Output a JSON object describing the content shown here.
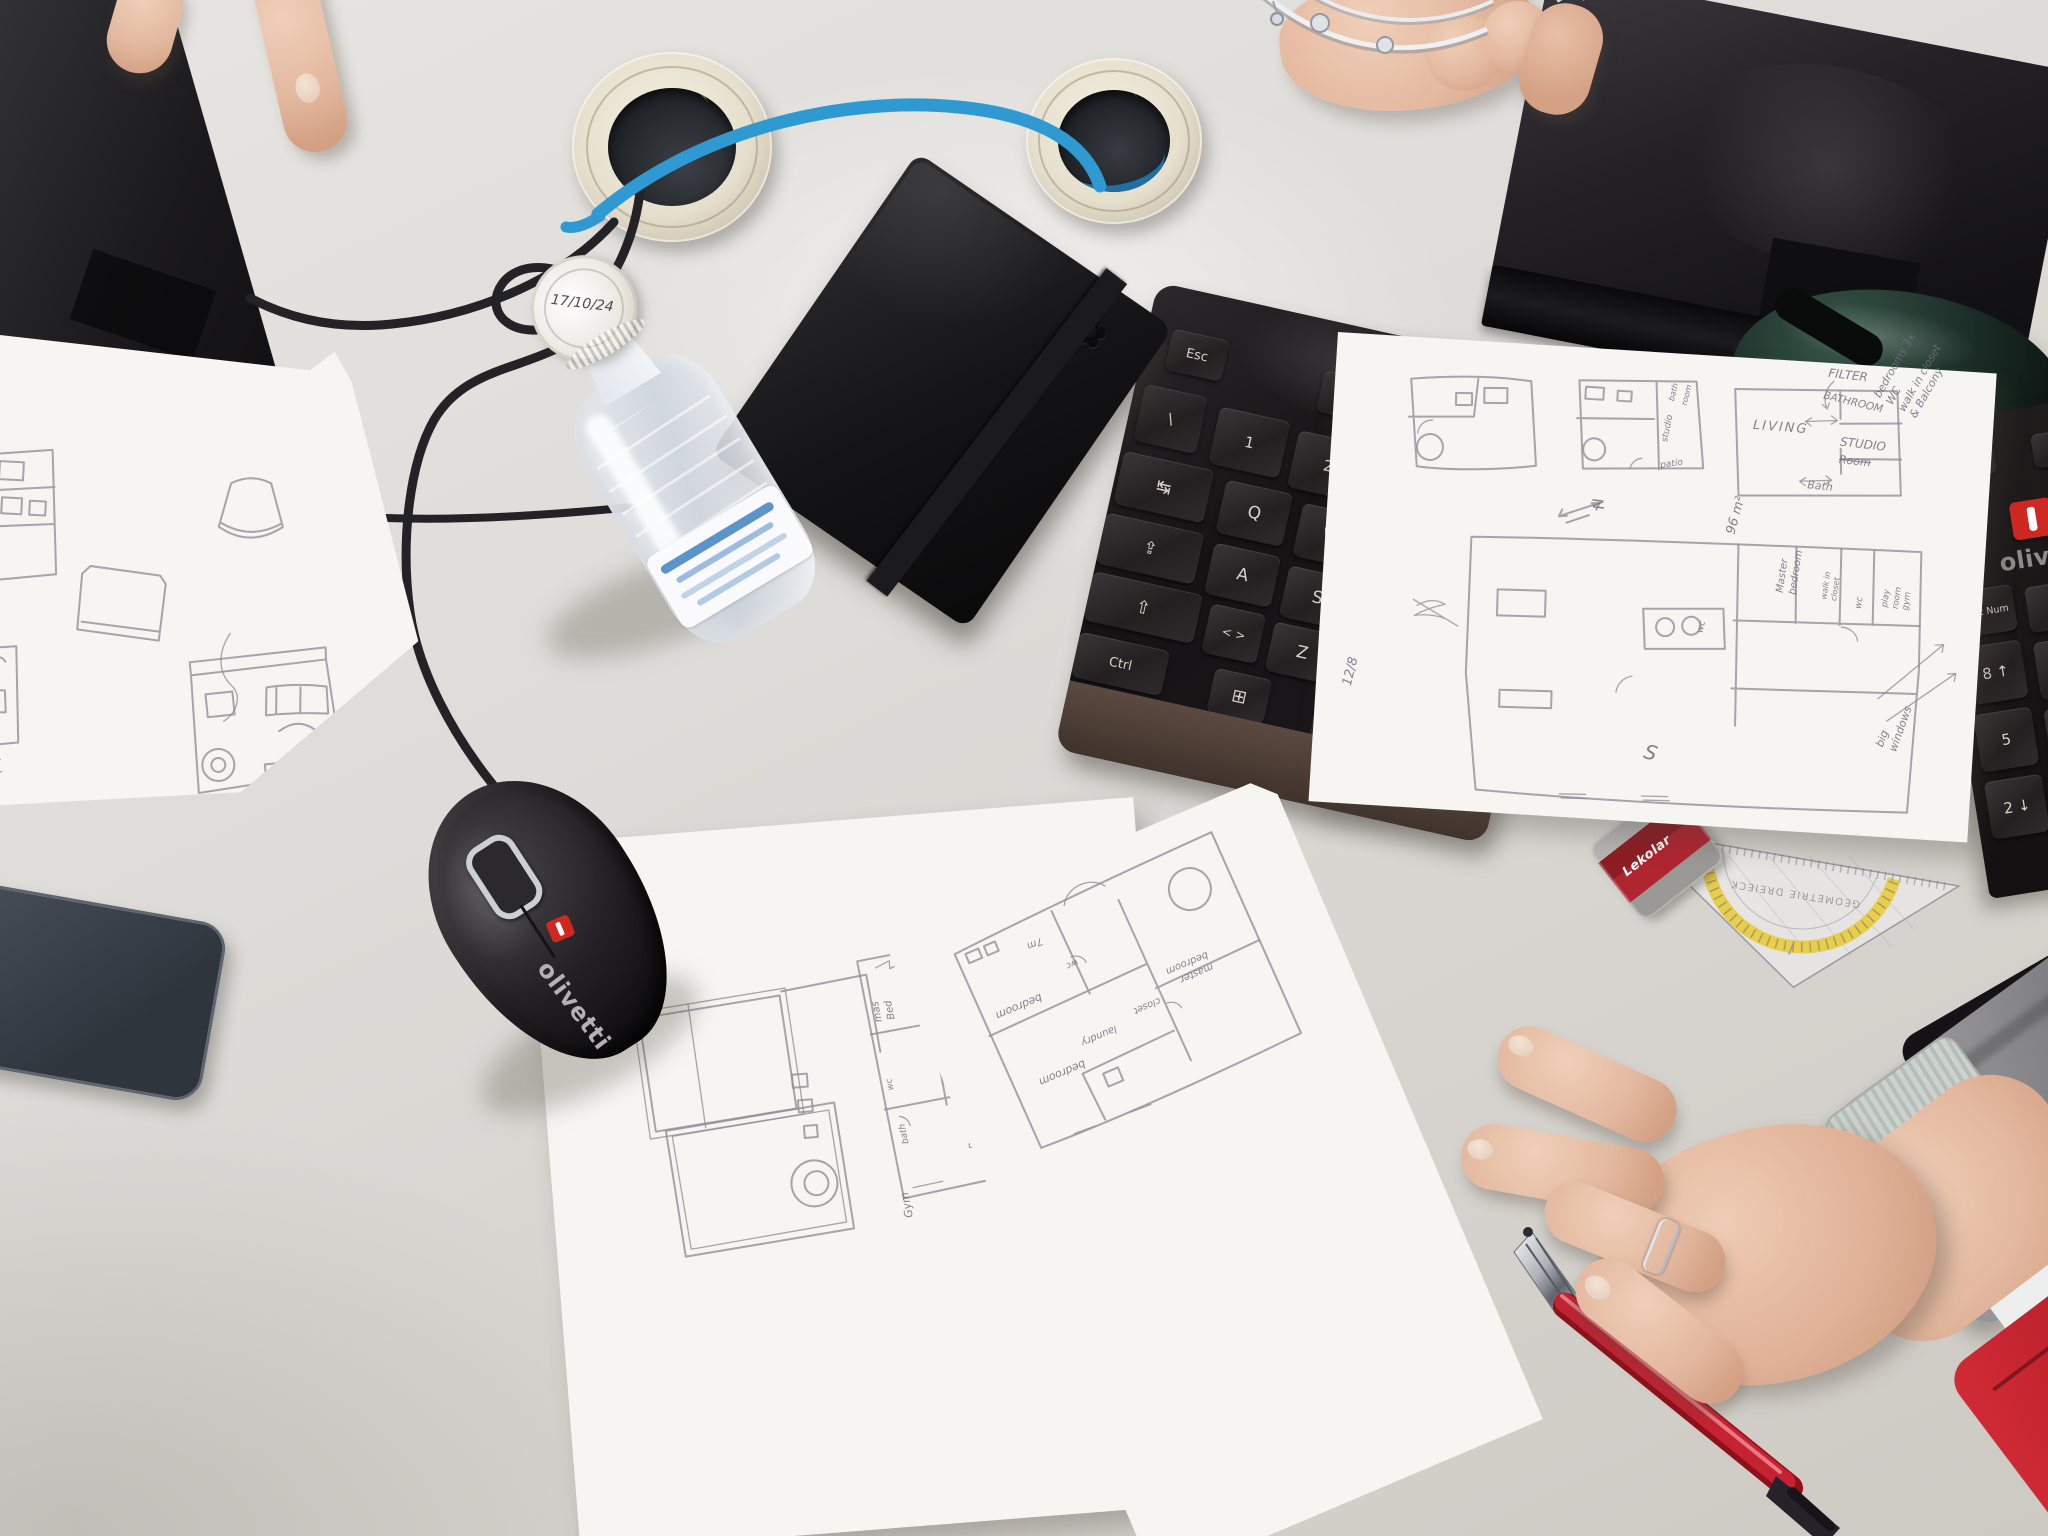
{
  "colors": {
    "desk": "#dedcd8",
    "cable_blue": "#2f9ad2",
    "accent_red": "#c5252b",
    "pen_red": "#c52233",
    "sleeve_red": "#c6232e"
  },
  "bottle": {
    "cap_date": "17/10/24"
  },
  "notebook": {
    "logo_icon": {
      "name": "flower-emblem",
      "glyph": "✿"
    }
  },
  "mouse": {
    "brand": "olivetti"
  },
  "monitor_right": {
    "brand": "FUJITSU"
  },
  "keyboard_center": {
    "keys": [
      "Esc",
      "F1",
      "F2",
      "\\",
      "1",
      "2",
      "3",
      "↹",
      "Q",
      "W",
      "⇪",
      "A",
      "S",
      "⇧",
      "< >",
      "Z",
      "X",
      "Ctrl",
      "⊞",
      "Alt"
    ]
  },
  "keyboard_right": {
    "indicators": [
      "1",
      "A"
    ],
    "brand": "olivetti",
    "keys": [
      "Bloc Num",
      "/",
      "8 ↑",
      "5",
      "2 ↓",
      "9",
      "6",
      "3"
    ]
  },
  "protractor": {
    "brand": "Lekolar",
    "label": "GEOMETRIE DREIECK"
  },
  "paper_top_right": {
    "plan_b": {
      "labels": [
        "bath",
        "room",
        "studio",
        "patio"
      ]
    },
    "plan_c": {
      "room": "LIVING",
      "filter": "FILTER",
      "bathroom": "BATHROOM",
      "studio": "STUDIO",
      "crossed": "Room",
      "bath": "Bath"
    },
    "side_notes": [
      "bedrooms 3x",
      "WC",
      "walk in closet",
      "& Balcony"
    ],
    "area": "96 m²",
    "compass": "N",
    "date": "12/8",
    "plan_d": {
      "master": [
        "Master",
        "bedroom"
      ],
      "closet": [
        "walk in",
        "closet"
      ],
      "wc": "wc",
      "gym": [
        "play",
        "room",
        "gym"
      ],
      "wc2": "wc",
      "south": "S"
    },
    "windows_note": [
      "big",
      "windows"
    ]
  },
  "paper_bottom_right": {
    "labels": {
      "len": "7m",
      "wc": "wc",
      "bed1": "bedroom",
      "bed2": "bedroom",
      "master": [
        "master",
        "bedroom"
      ],
      "laundry": "laundry",
      "closet": "closet"
    }
  },
  "paper_bottom_left": {
    "labels": {
      "mas": [
        "mas",
        "Bed"
      ],
      "closet": "closet",
      "wc1": "wc",
      "bed1": "Bed",
      "wc2": "wc",
      "bath": "bath",
      "bed2": "Bed",
      "gym": "Gym"
    }
  }
}
